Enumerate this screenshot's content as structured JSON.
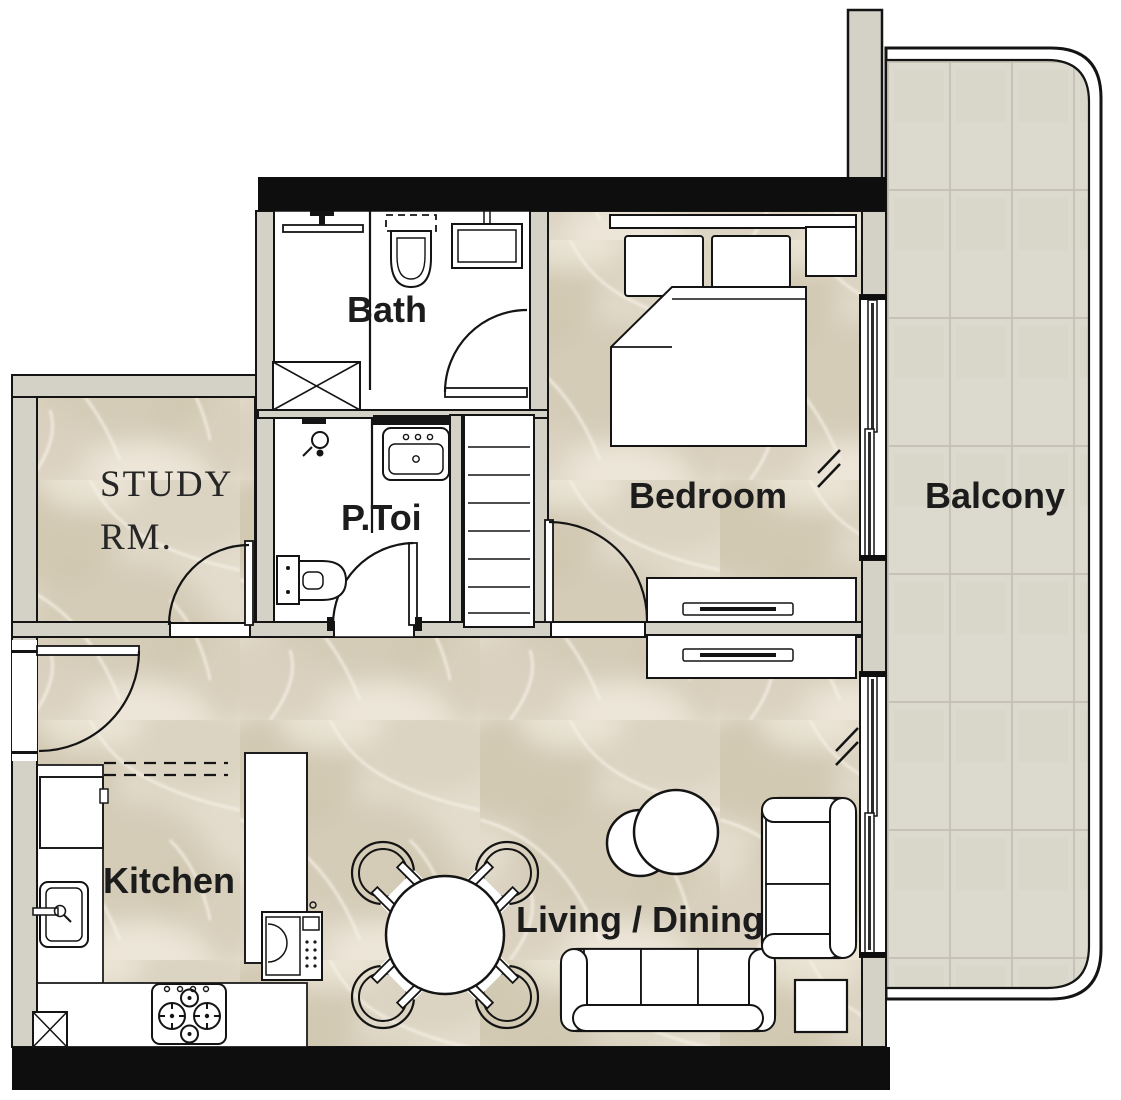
{
  "rooms": {
    "bath": {
      "label": "Bath"
    },
    "powder_toilet": {
      "label": "P.Toi"
    },
    "study": {
      "label_line1": "STUDY",
      "label_line2": "RM."
    },
    "bedroom": {
      "label": "Bedroom"
    },
    "balcony": {
      "label": "Balcony"
    },
    "kitchen": {
      "label": "Kitchen"
    },
    "living_dining": {
      "label": "Living / Dining"
    }
  },
  "colors": {
    "wall_black": "#0e0e0e",
    "wall_gray": "#d4d1c6",
    "floor_marble_base": "#e3dccd",
    "balcony_tile": "#dcd9ce",
    "tile_grout": "#c6c3b6",
    "line": "#141414",
    "background": "#ffffff"
  },
  "furniture_icons": [
    "double-bed-icon",
    "pillow-icon",
    "bedside-table-icon",
    "wardrobe-icon",
    "dresser-icon",
    "round-dining-table-icon",
    "dining-chair-icon",
    "sofa-icon",
    "loveseat-icon",
    "coffee-table-icon",
    "side-table-icon",
    "kitchen-sink-icon",
    "faucet-icon",
    "gas-stove-icon",
    "oven-microwave-icon",
    "refrigerator-icon",
    "washing-machine-icon",
    "toilet-icon",
    "vanity-sink-icon",
    "shower-head-icon",
    "shower-partition-icon",
    "linen-closet-icon",
    "door-swing-icon",
    "sliding-window-icon",
    "window-opening-symbol",
    "overhead-cabinet-dashed-icon"
  ]
}
